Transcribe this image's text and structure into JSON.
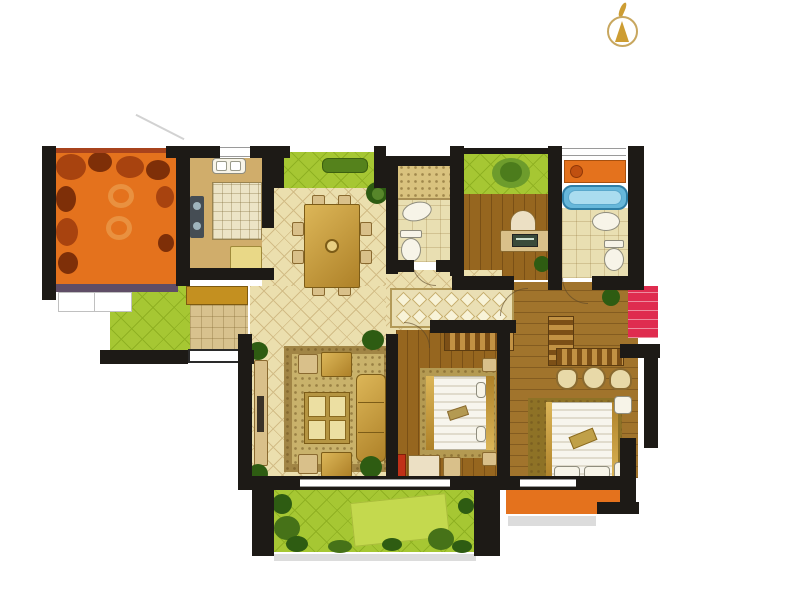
{
  "meta": {
    "type": "residential-floor-plan",
    "width": 800,
    "height": 611
  },
  "compass": {
    "icon": "north-arrow"
  },
  "palette": {
    "bg": "#ffffff",
    "wall": "#1d1a16",
    "terrace_floor": "#e4721d",
    "terrace_foliage": "#a8430f",
    "terrace_foliage_dark": "#7e2f08",
    "terrace_rail_top": "#a8431c",
    "terrace_rail_bottom": "#5f4d66",
    "garden_green": "#a6c733",
    "garden_line": "#8fb122",
    "garden_mat": "#c4d94e",
    "bench_green": "#55821c",
    "bush_green": "#2e5c12",
    "tile_floor": "#ebdfae",
    "tile_line": "#d2bc86",
    "kitchen_floor": "#d0ad6b",
    "counter": "#ece4c6",
    "cooktop": "#454d54",
    "fridge": "#e9d887",
    "bath_floor": "#e9dfb2",
    "wood_floor": "#96661f",
    "wood_master": "#a1742c",
    "tub_blue": "#66b7da",
    "tub_inner": "#aadcef",
    "red_bay": "#df2c4f",
    "orange_bay": "#e4721d",
    "rug_outer": "#a18545",
    "rug_inner": "#c9b26b",
    "rug_master": "#8e7226",
    "runner_bg": "#eadfb4",
    "runner_diamond": "#f8f3d8",
    "gold_a": "#dcb658",
    "gold_b": "#ae8128",
    "mustard_cabinet": "#c49020",
    "foyer_tile": "#d8c28e",
    "ward_a": "#7c4f16",
    "ward_b": "#c29244",
    "duvet_a": "#f7f5ed",
    "duvet_b": "#e0dbcc",
    "fixture": "#f7f4e8",
    "shadow": "#dcdcdc",
    "compass_ring": "#c8a75f",
    "compass_arrow": "#cd9d33"
  },
  "rooms": [
    {
      "id": "terrace",
      "fill": "terrace_floor"
    },
    {
      "id": "kitchen",
      "fill": "kitchen_floor"
    },
    {
      "id": "north-garden-dining",
      "fill": "garden_green"
    },
    {
      "id": "dining-room",
      "fill": "tile_floor"
    },
    {
      "id": "bathroom-main",
      "fill": "bath_floor"
    },
    {
      "id": "north-garden-study",
      "fill": "garden_green"
    },
    {
      "id": "study",
      "fill": "wood_floor"
    },
    {
      "id": "bathroom-ensuite",
      "fill": "bath_floor"
    },
    {
      "id": "entry-foyer",
      "fill": "foyer_tile"
    },
    {
      "id": "side-patio",
      "fill": "garden_green"
    },
    {
      "id": "living-room",
      "fill": "tile_floor"
    },
    {
      "id": "hallway",
      "fill": "runner_bg"
    },
    {
      "id": "bedroom",
      "fill": "wood_floor"
    },
    {
      "id": "master-bedroom",
      "fill": "wood_master"
    },
    {
      "id": "south-balcony",
      "fill": "garden_green"
    },
    {
      "id": "red-bay-window",
      "fill": "red_bay"
    },
    {
      "id": "orange-bay-window",
      "fill": "orange_bay"
    }
  ]
}
